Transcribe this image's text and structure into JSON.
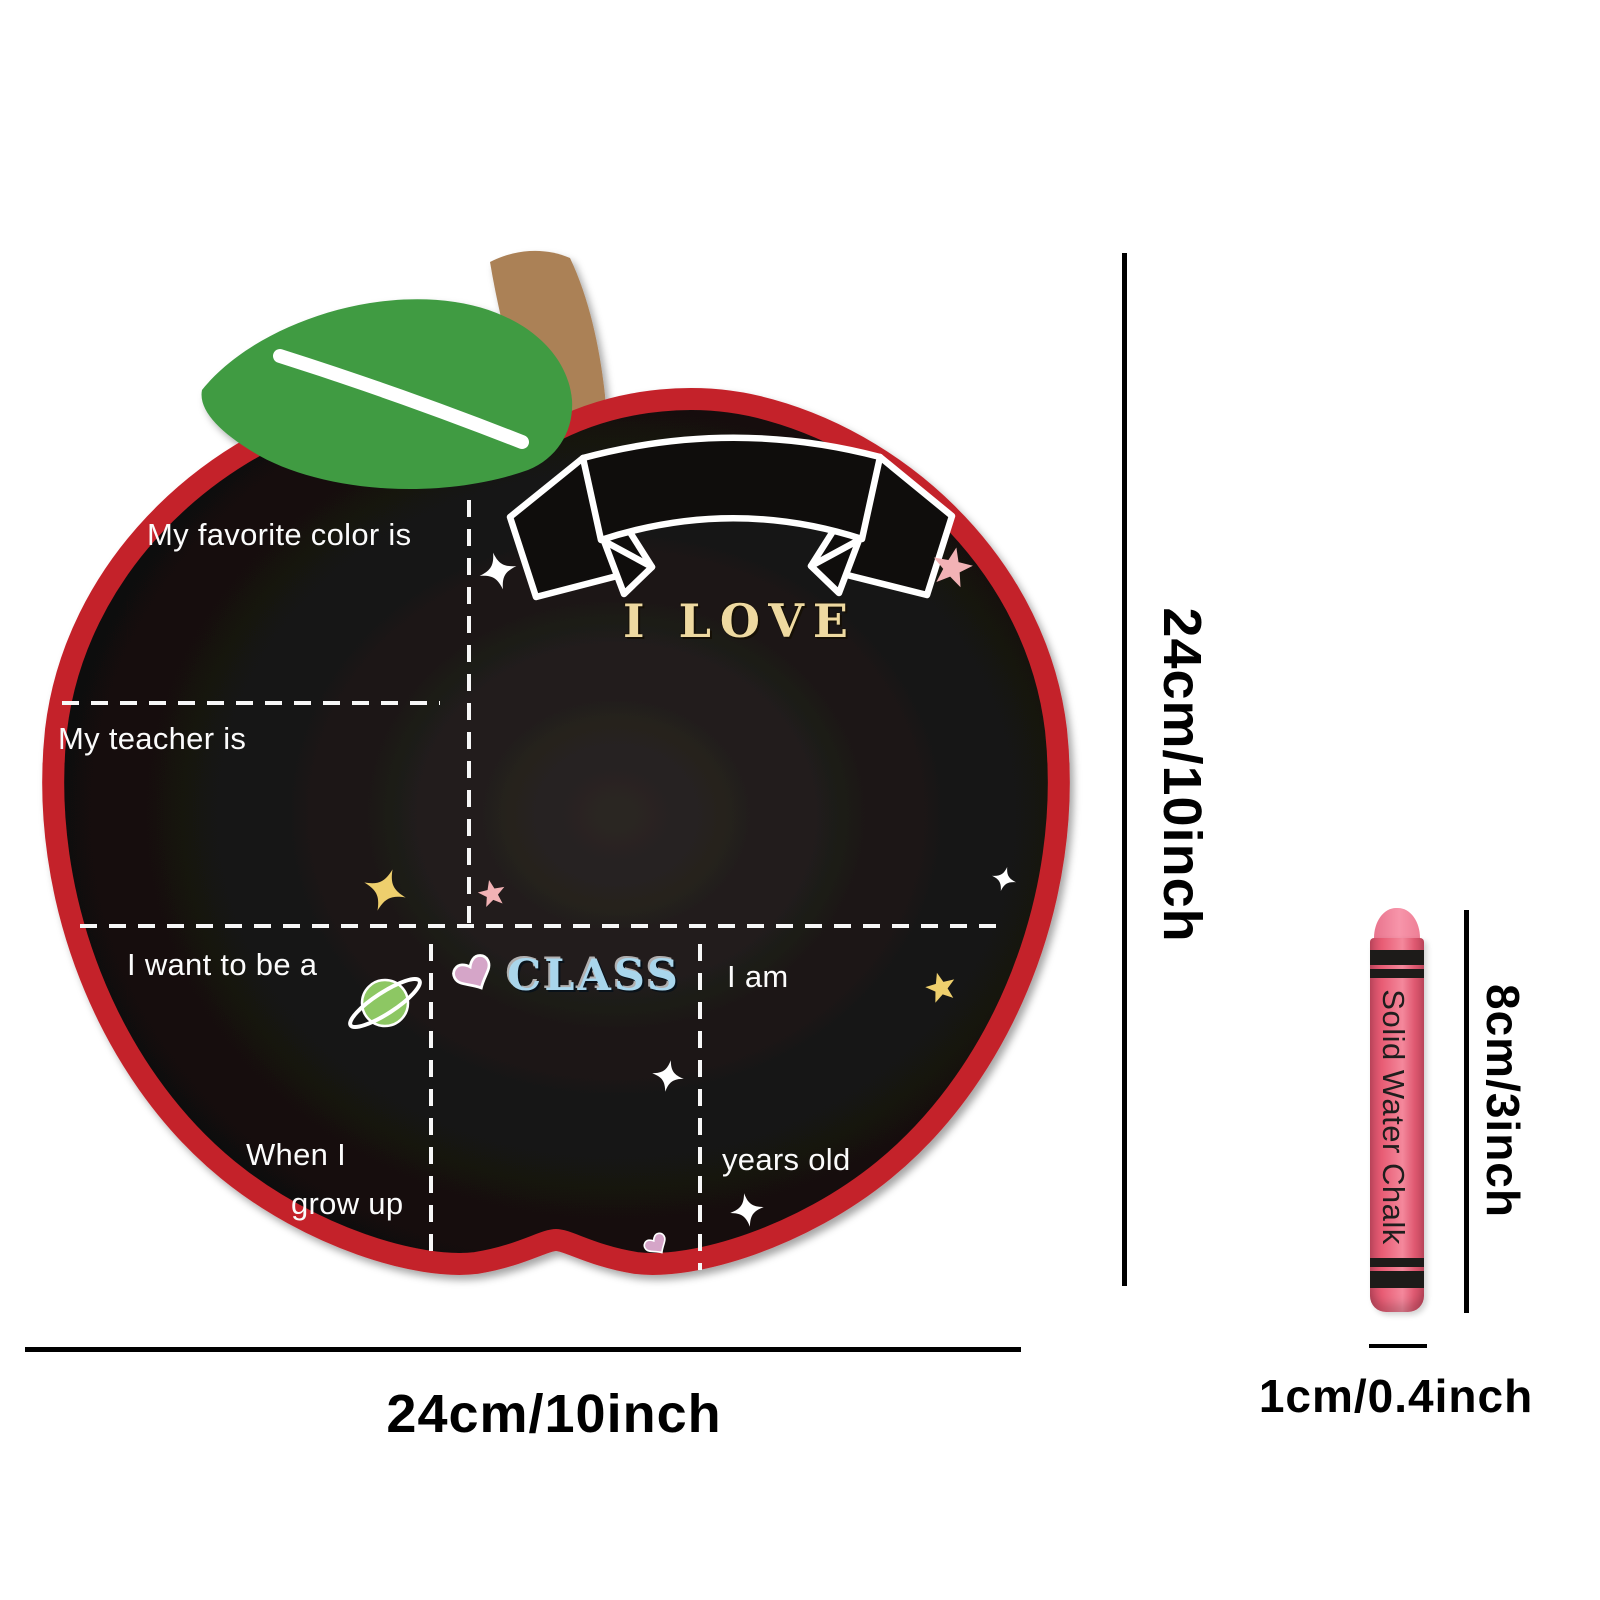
{
  "board": {
    "banner_text": "I LOVE",
    "class_text": "CLASS",
    "fields": {
      "favorite_color": "My favorite color is",
      "teacher": "My teacher is",
      "want_to_be": "I want to be a",
      "i_am": "I am",
      "when_i": "When I",
      "grow_up": "grow up",
      "years_old": "years old"
    },
    "colors": {
      "border_red": "#c4222a",
      "surface_black": "#141110",
      "leaf_green": "#3f9b42",
      "stem_brown": "#ab8157",
      "chalk_line_white": "#f7f7f7",
      "banner_text_gold": "#eed9a0",
      "class_text_blue": "#a9d6ec"
    }
  },
  "dimensions": {
    "board_height_label": "24cm/10inch",
    "board_width_label": "24cm/10inch",
    "chalk_height_label": "8cm/3inch",
    "chalk_width_label": "1cm/0.4inch"
  },
  "chalk": {
    "brand_text": "Solid Water Chalk",
    "body_pink": "#e85c74",
    "tip_pink": "#f4839a",
    "band_black": "#1d1b19"
  },
  "decorations": {
    "white_sparkles": 4,
    "yellow_sparkle": 1,
    "pink_stars": 2,
    "yellow_star": 1,
    "pink_hearts": 2,
    "ringed_planet": 1,
    "sparkle_white": "#ffffff",
    "sparkle_yellow": "#eecf6d",
    "star_pink": "#f2b2b5",
    "heart_mauve": "#d5a5c8",
    "planet_green": "#8dc763"
  }
}
